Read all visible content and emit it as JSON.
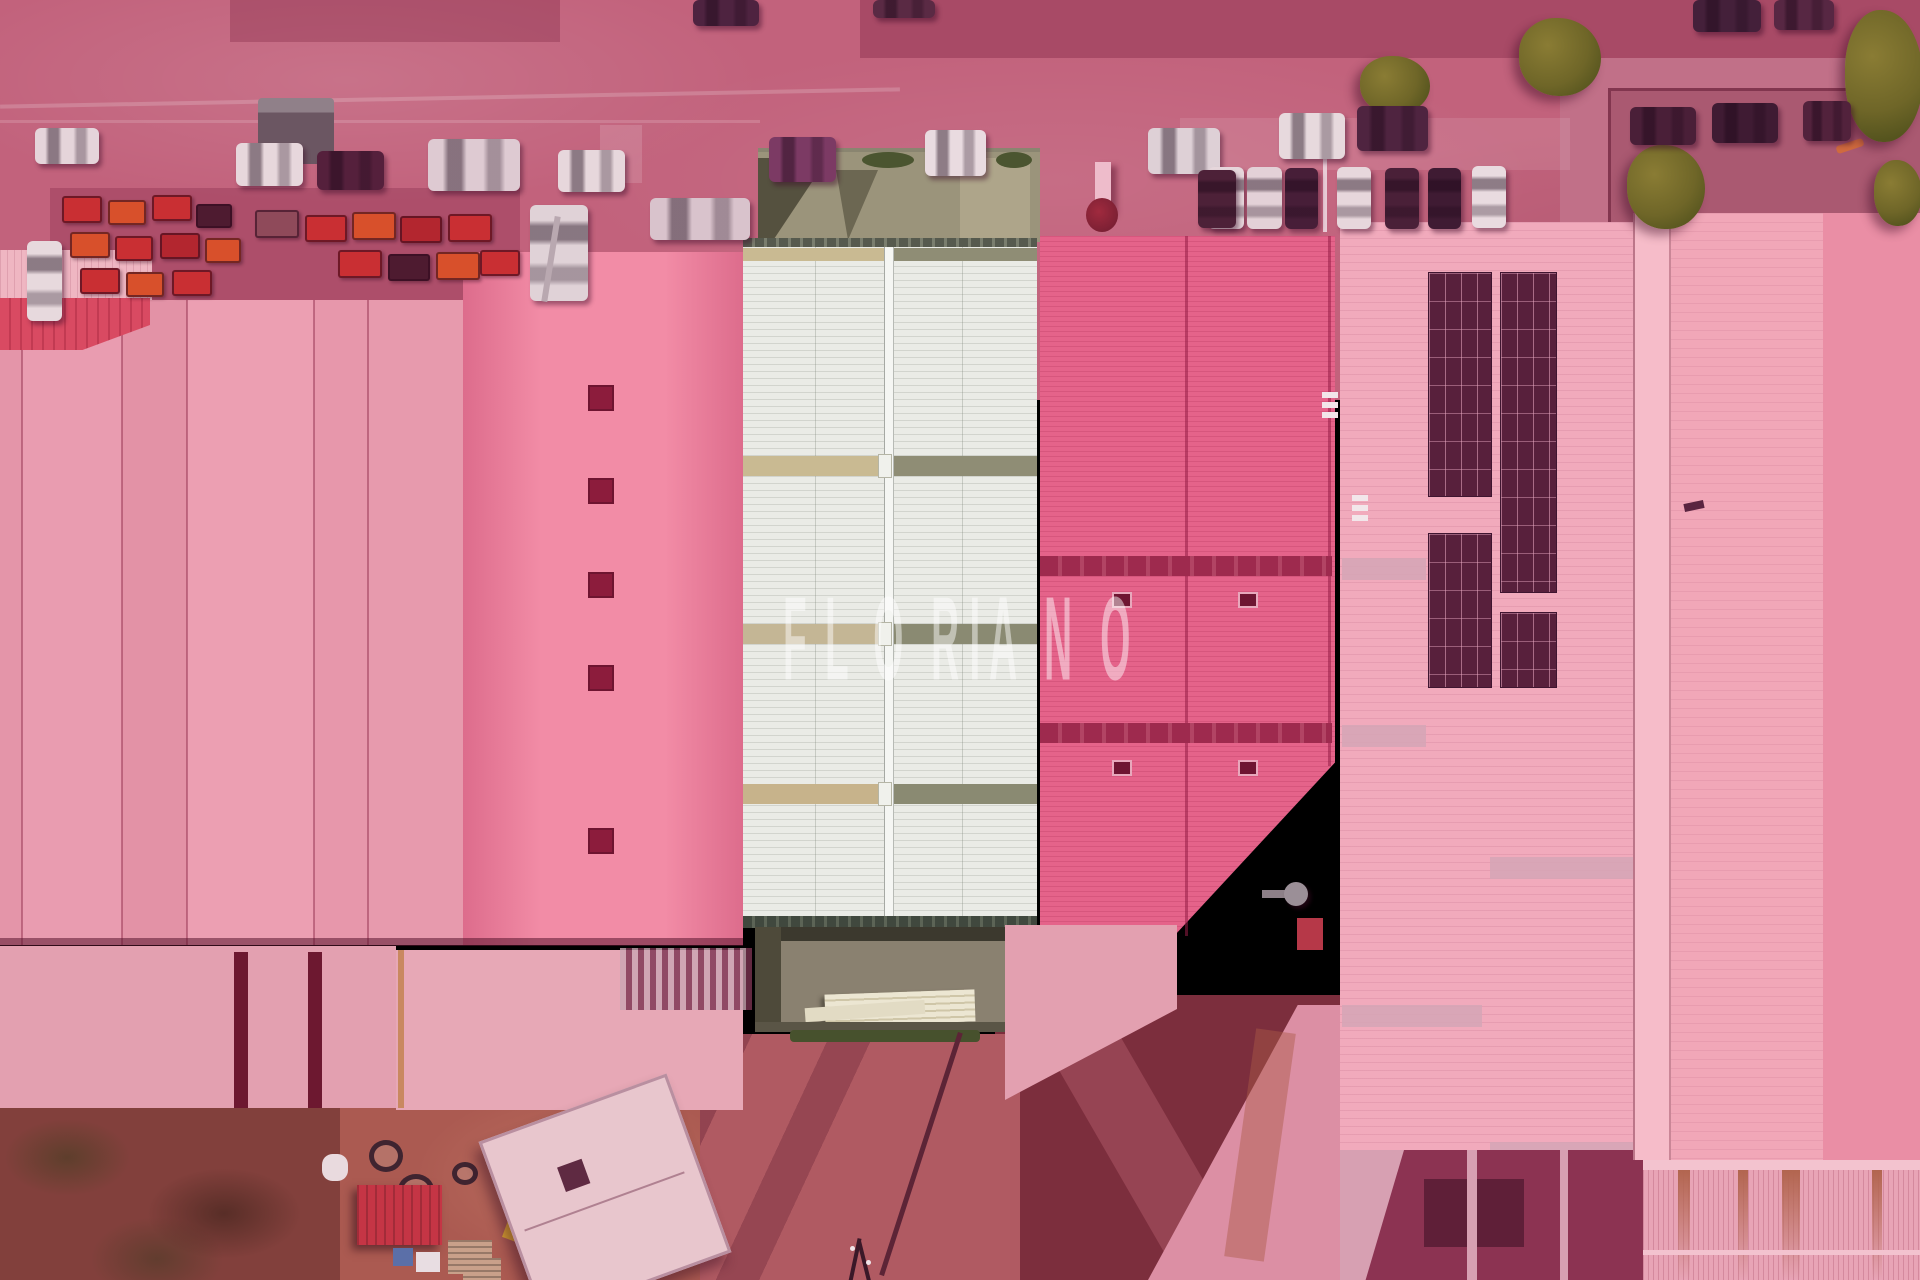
{
  "image_type": "aerial-drone-photo",
  "description": "Top-down aerial photograph of an industrial warehouse complex with roads and parked cars; a red/pink listing-highlight filter covers everything except one central warehouse unit (white roof with skylight stripes and two natural-color courtyards); agency watermark across the middle",
  "watermark": {
    "text": "FLORIANO"
  },
  "palette": {
    "road": "#c2627c",
    "road_dark": "#a84a66",
    "parking": "#c17088",
    "roof_a": "#e79aad",
    "roof_white": "#eaebe6",
    "stripe_tan": "#c9ba92",
    "stripe_olive": "#8f8d75",
    "courtyard": "#9b947b",
    "courtyard_dark": "#55513f",
    "roof_d": "#e5638a",
    "walkway_d": "#9e2a4e",
    "roof_c": "#f1aabc",
    "solar": "#58203c",
    "walkway_c": "#d5a6b6",
    "roof_f": "#f1a7b8",
    "roof_f_dark": "#ea8ea5",
    "ridge_f": "#f6bcc9",
    "annex": "#e3a0b0",
    "ground_dark": "#7c2e3d",
    "scrub": "#82403c",
    "dirt": "#ab5a51",
    "container_red": "#c53545",
    "vent_dark": "#8c1c3c",
    "white_building": "#e8c6cd",
    "watermark": "rgba(255,255,255,0.47)"
  },
  "vehicles": [
    [
      35,
      128,
      64,
      36,
      "#e5d4da",
      "h"
    ],
    [
      236,
      143,
      67,
      43,
      "#e7d7dc",
      "h"
    ],
    [
      317,
      151,
      67,
      39,
      "#55203c",
      "h"
    ],
    [
      428,
      139,
      92,
      52,
      "#decad2",
      "h"
    ],
    [
      558,
      150,
      67,
      42,
      "#e7d7dc",
      "h"
    ],
    [
      650,
      198,
      100,
      42,
      "#d9c3cc",
      "h"
    ],
    [
      769,
      137,
      67,
      45,
      "#7c3a64",
      "h"
    ],
    [
      925,
      130,
      61,
      46,
      "#e9dbe0",
      "h"
    ],
    [
      1148,
      128,
      72,
      46,
      "#ded0d6",
      "h"
    ],
    [
      1279,
      113,
      66,
      46,
      "#e7d9dd",
      "h"
    ],
    [
      1357,
      106,
      71,
      45,
      "#4f2440",
      "h"
    ],
    [
      1630,
      107,
      66,
      38,
      "#4a1f38",
      "h"
    ],
    [
      1712,
      103,
      66,
      40,
      "#3f1b33",
      "h"
    ],
    [
      1803,
      101,
      48,
      40,
      "#52223c",
      "h"
    ],
    [
      693,
      0,
      66,
      26,
      "#4e2340",
      "h"
    ],
    [
      873,
      0,
      62,
      18,
      "#5a2a44",
      "h"
    ],
    [
      1693,
      0,
      68,
      32,
      "#44203a",
      "h"
    ],
    [
      1774,
      0,
      60,
      30,
      "#572743",
      "h"
    ],
    [
      1208,
      167,
      36,
      62,
      "#e6d6db",
      "v"
    ],
    [
      1247,
      167,
      35,
      62,
      "#e3d1d7",
      "v"
    ],
    [
      1285,
      168,
      33,
      61,
      "#471e38",
      "v"
    ],
    [
      1337,
      167,
      34,
      62,
      "#e7d7dc",
      "v"
    ],
    [
      1385,
      168,
      34,
      61,
      "#4a2038",
      "v"
    ],
    [
      1428,
      168,
      33,
      61,
      "#3f1b33",
      "v"
    ],
    [
      1472,
      166,
      34,
      62,
      "#e9dbe0",
      "v"
    ],
    [
      1198,
      170,
      38,
      58,
      "#4d2138",
      "v"
    ],
    [
      27,
      241,
      35,
      80,
      "#e7d9dd",
      "v"
    ],
    [
      530,
      205,
      58,
      96,
      "#e0d2d7",
      "v"
    ]
  ],
  "machines": [
    [
      62,
      196,
      40,
      27,
      "#c92f33"
    ],
    [
      108,
      200,
      38,
      25,
      "#d8502b"
    ],
    [
      152,
      195,
      40,
      26,
      "#c92f33"
    ],
    [
      196,
      204,
      36,
      24,
      "#4e1b30"
    ],
    [
      70,
      232,
      40,
      26,
      "#d8502b"
    ],
    [
      115,
      236,
      38,
      25,
      "#c92f33"
    ],
    [
      160,
      233,
      40,
      26,
      "#b3262f"
    ],
    [
      205,
      238,
      36,
      25,
      "#d8502b"
    ],
    [
      80,
      268,
      40,
      26,
      "#c92f33"
    ],
    [
      126,
      272,
      38,
      25,
      "#d8502b"
    ],
    [
      172,
      270,
      40,
      26,
      "#c92f33"
    ],
    [
      255,
      210,
      44,
      28,
      "#8f4a5a"
    ],
    [
      305,
      215,
      42,
      27,
      "#c92f33"
    ],
    [
      352,
      212,
      44,
      28,
      "#d8502b"
    ],
    [
      400,
      216,
      42,
      27,
      "#b3262f"
    ],
    [
      448,
      214,
      44,
      28,
      "#c92f33"
    ],
    [
      338,
      250,
      44,
      28,
      "#c92f33"
    ],
    [
      388,
      254,
      42,
      27,
      "#4e1b30"
    ],
    [
      436,
      252,
      44,
      28,
      "#d8502b"
    ],
    [
      480,
      250,
      40,
      26,
      "#c92f33"
    ]
  ],
  "trees": [
    [
      1627,
      145,
      78,
      84
    ],
    [
      1845,
      10,
      78,
      132
    ],
    [
      1874,
      160,
      48,
      66
    ],
    [
      1519,
      18,
      82,
      78
    ],
    [
      1360,
      56,
      70,
      58
    ]
  ],
  "tires": [
    [
      369,
      1140,
      34,
      32
    ],
    [
      398,
      1174,
      36,
      32
    ],
    [
      452,
      1162,
      26,
      23
    ]
  ]
}
